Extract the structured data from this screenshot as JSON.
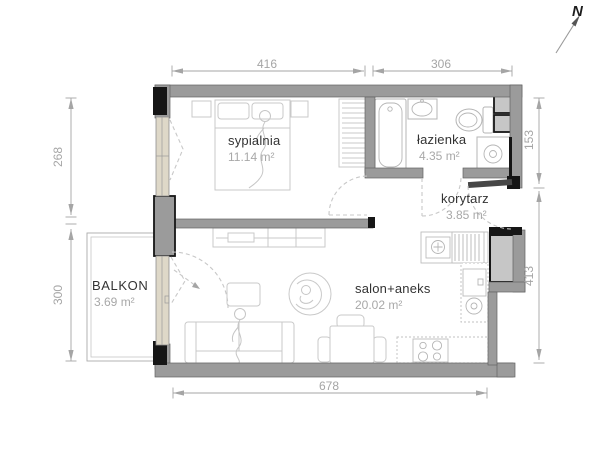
{
  "title": "apartment floor plan",
  "compass": {
    "label": "N"
  },
  "rooms": [
    {
      "id": "sypialnia",
      "name": "sypialnia",
      "area": "11.14 m²"
    },
    {
      "id": "lazienka",
      "name": "łazienka",
      "area": "4.35 m²"
    },
    {
      "id": "korytarz",
      "name": "korytarz",
      "area": "3.85 m²"
    },
    {
      "id": "salon-aneks",
      "name": "salon+aneks",
      "area": "20.02 m²"
    },
    {
      "id": "balkon",
      "name": "BALKON",
      "area": "3.69 m²"
    }
  ],
  "dimensions": {
    "top": [
      "416",
      "306"
    ],
    "bottom": [
      "678"
    ],
    "left": [
      "268",
      "300"
    ],
    "right": [
      "153",
      "413"
    ]
  },
  "colors": {
    "wall": "#9b9b9b",
    "blk": "#161616",
    "win": "#ded8c8",
    "furn": "#c9c9c9",
    "dim": "#a5a5a5",
    "name": "#333333",
    "area": "#a8a8a8"
  }
}
